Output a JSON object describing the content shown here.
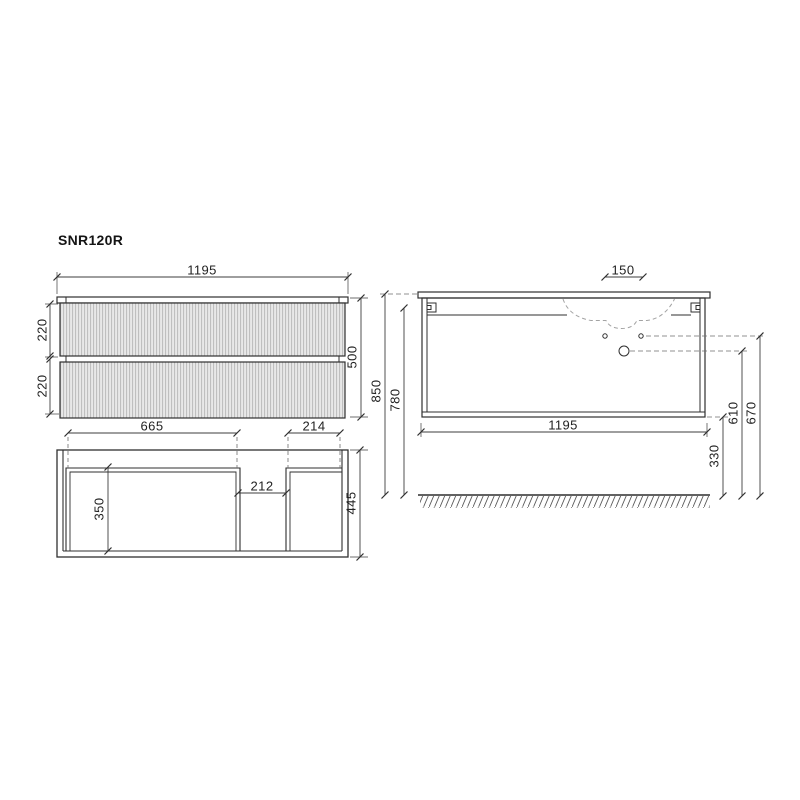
{
  "title": "SNR120R",
  "drawing": {
    "front_view": {
      "width": "1195",
      "top_drawer_height": "220",
      "bottom_drawer_height": "220",
      "total_height": "500"
    },
    "plan_view": {
      "left_drawer_width": "665",
      "right_drawer_width": "214",
      "center_gap": "212",
      "inner_depth": "350",
      "total_depth": "445"
    },
    "side_view": {
      "tap_hole_spacing": "150",
      "height_floor_to_counter": "850",
      "height_floor_to_cabinet_top": "780",
      "width": "1195",
      "clearance_under_cabinet": "330",
      "drain_hole_height": "610",
      "supply_hole_height": "670"
    }
  },
  "colors": {
    "outline": "#2f2f2f",
    "dimension_line": "#3d3d3d",
    "dashed_line": "#6e6e6e",
    "basin_outline": "#a3a3a3",
    "flute_light": "#e8e8e8",
    "flute_dark": "#bfbfbf",
    "background": "#ffffff"
  }
}
